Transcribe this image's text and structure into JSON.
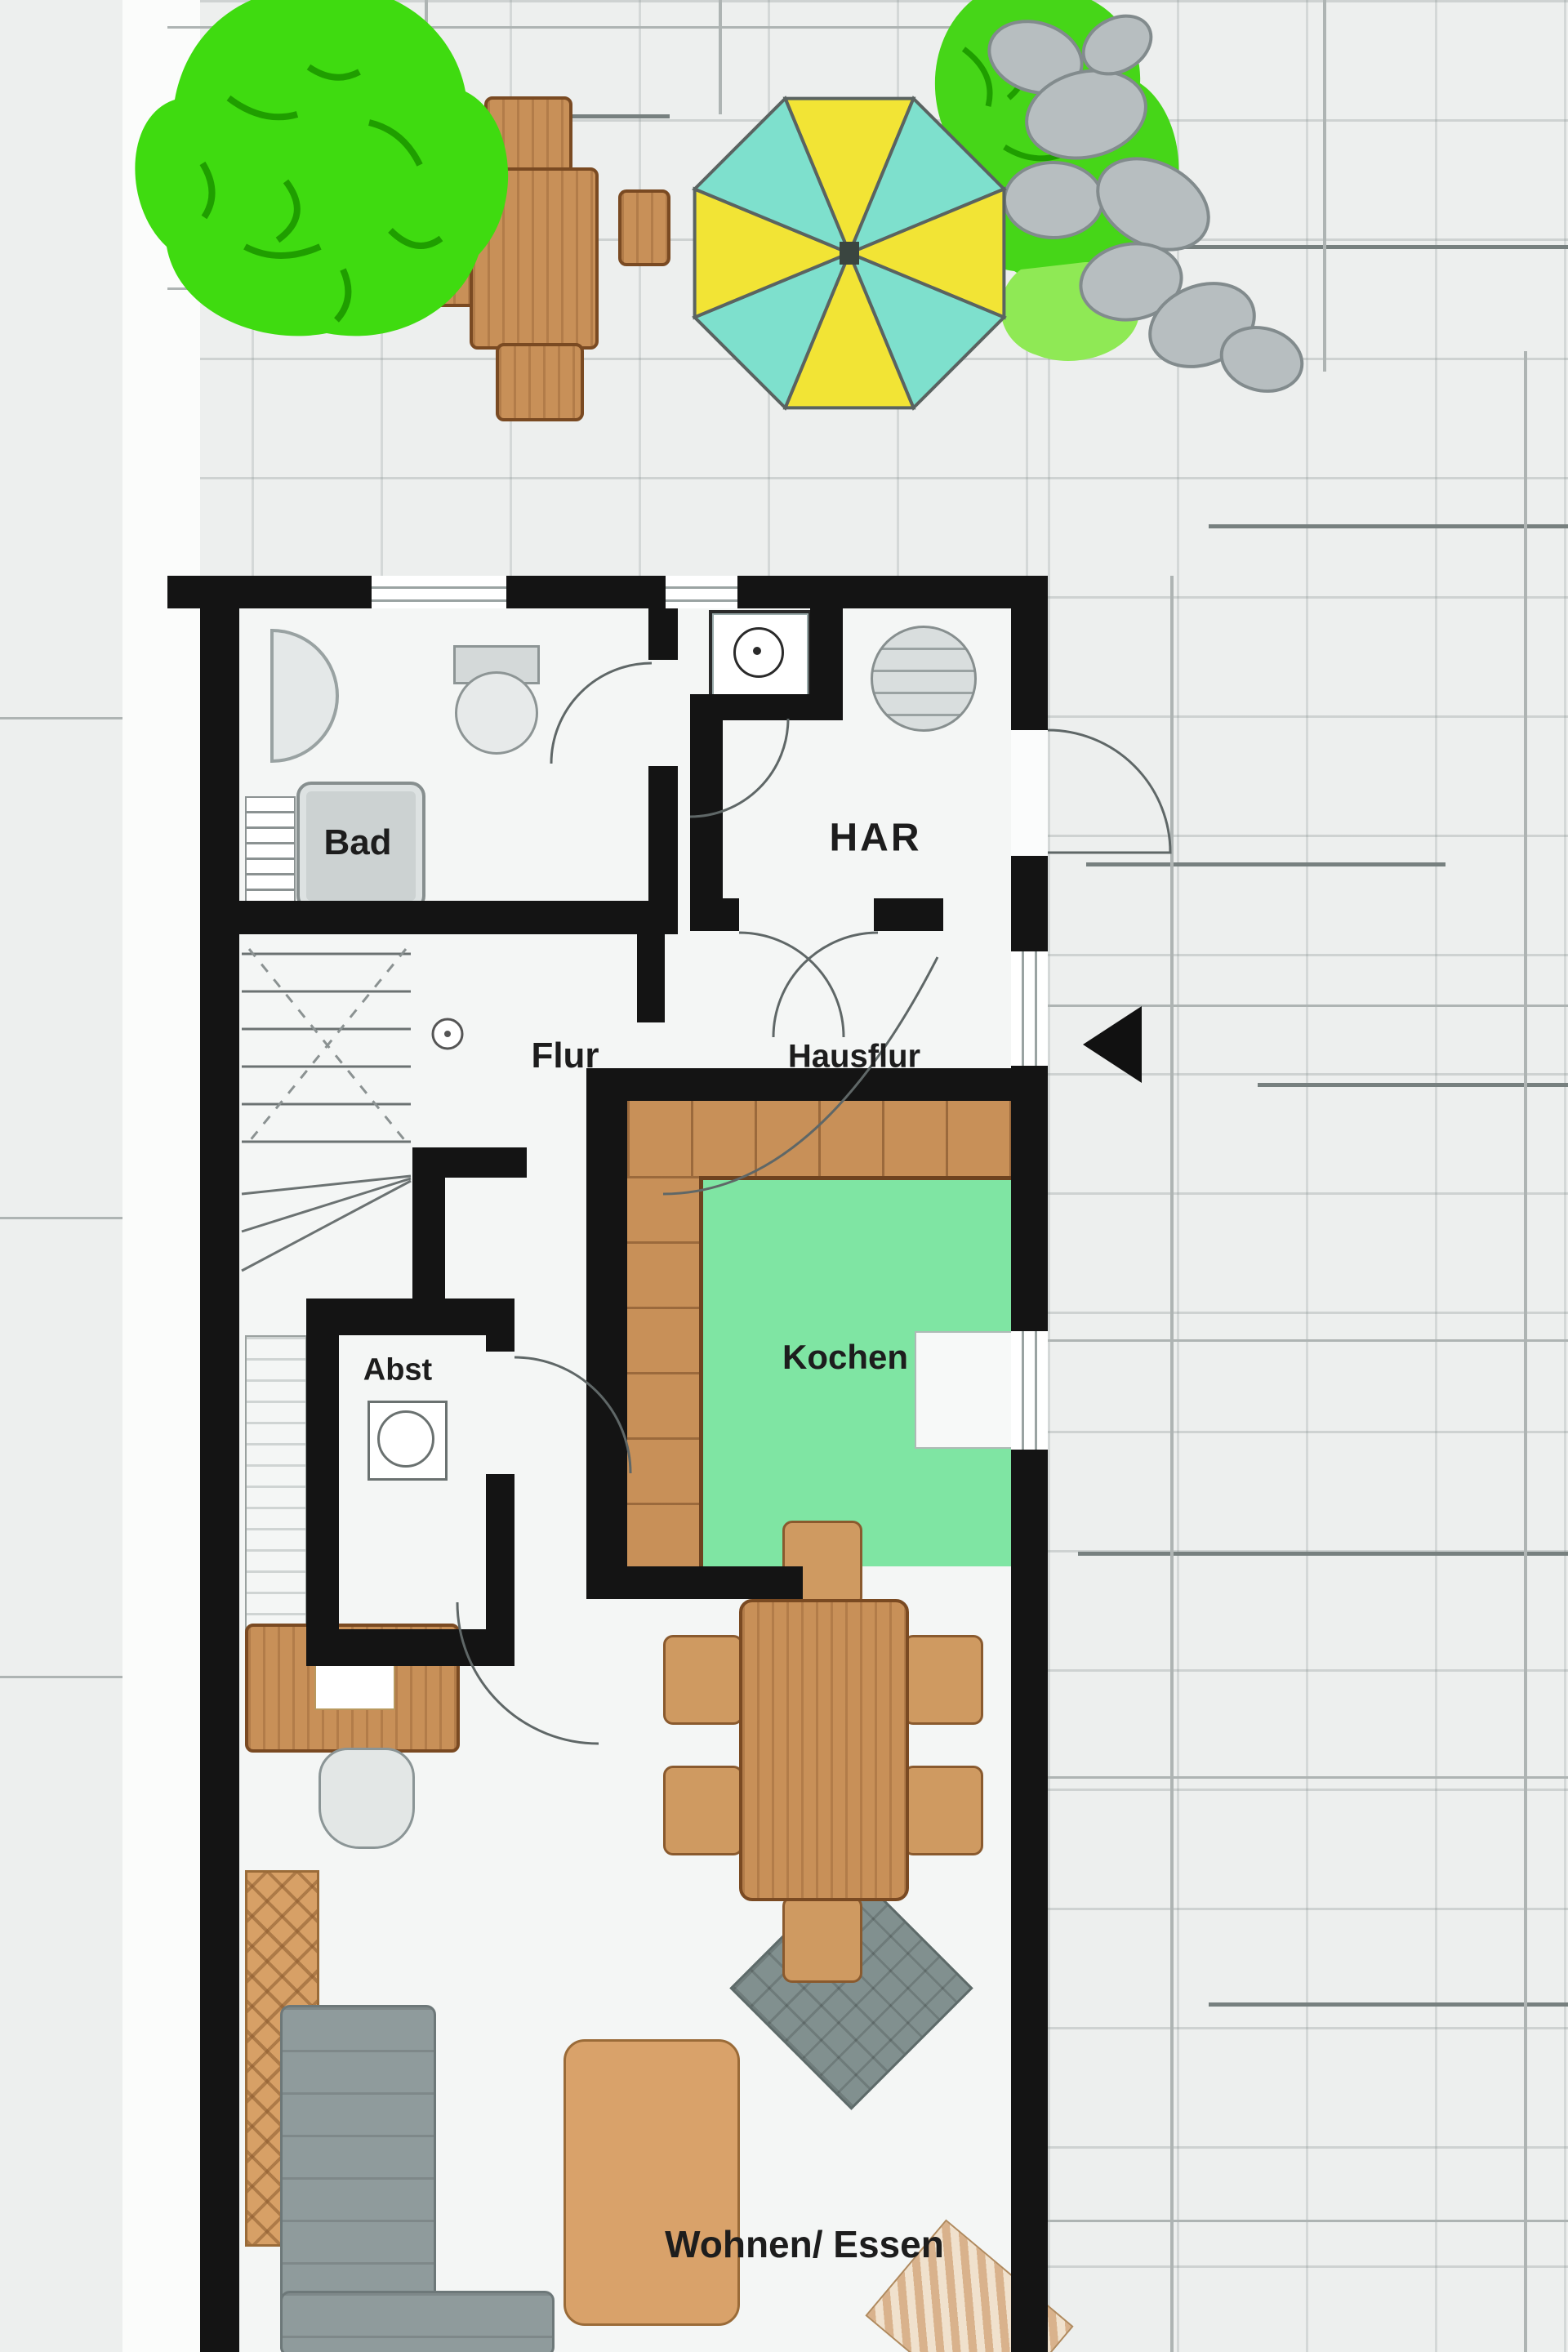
{
  "plan": {
    "kind": "ground-floor-plan",
    "rooms": {
      "bad": "Bad",
      "har": "HAR",
      "flur": "Flur",
      "hausflur": "Hausflur",
      "kochen": "Kochen",
      "abst": "Abst",
      "wohnen_essen": "Wohnen/ Essen"
    },
    "colors": {
      "wall": "#141414",
      "floor": "#f4f6f5",
      "outdoor": "#edefee",
      "kitchen_floor": "#7fe5a3",
      "tree_green": "#3fdb10",
      "shrub_green": "#46d618",
      "umbrella_yellow": "#f2e435",
      "umbrella_cyan": "#7ee0cd",
      "wood_brown": "#c89058",
      "sofa_gray": "#8f9b9c",
      "stone_gray": "#b7bec0"
    },
    "icons": {
      "tree-icon": "organic green canopy blob",
      "shrub-icon": "organic green bush blob",
      "stones-icon": "gray rock ellipse cluster",
      "umbrella-icon": "octagon parasol, 8 alternating slices",
      "entrance-arrow-icon": "left-pointing black triangle",
      "washing-machine-icon": "square with circle drum",
      "boiler-icon": "shaded circle",
      "toilet-icon": "tank rectangle with bowl ellipse",
      "shower-basin-icon": "half disc",
      "stairs-icon": "treads with dashed guide lines and circle"
    }
  }
}
